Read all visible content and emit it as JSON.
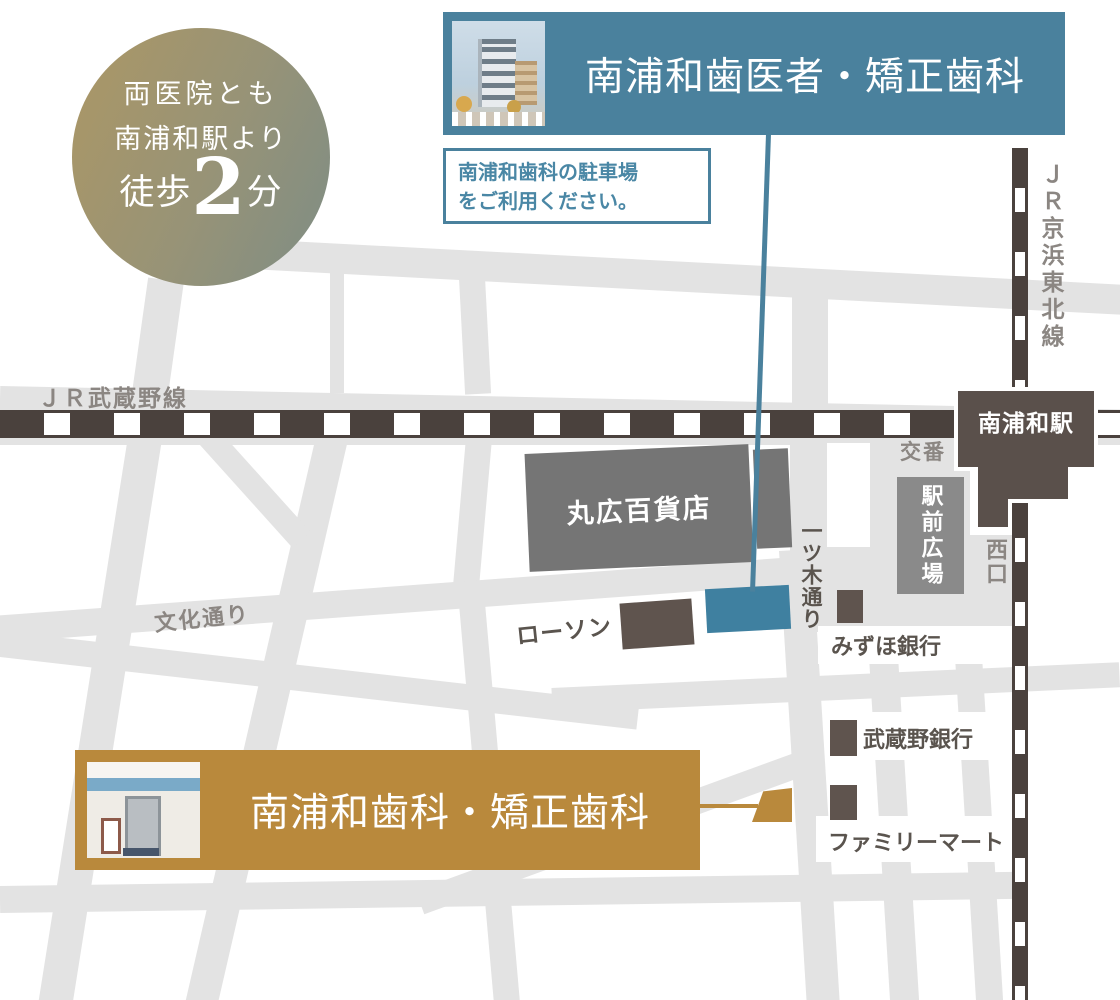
{
  "badge": {
    "line1": "両医院とも",
    "line2": "南浦和駅より",
    "walk_prefix": "徒歩",
    "walk_number": "2",
    "walk_suffix": "分"
  },
  "clinic_a": {
    "name": "南浦和歯医者・矯正歯科",
    "note_line1": "南浦和歯科の駐車場",
    "note_line2": "をご利用ください。"
  },
  "clinic_b": {
    "name": "南浦和歯科・矯正歯科"
  },
  "map": {
    "railways": {
      "musashino": "ＪＲ武蔵野線",
      "keihin_tohoku": "ＪＲ京浜東北線"
    },
    "station": {
      "name": "南浦和駅",
      "west_exit": "西口",
      "plaza": "駅前広場",
      "police_box": "交番"
    },
    "streets": {
      "hitotsugi": "一ツ木通り",
      "bunka": "文化通り"
    },
    "landmarks": {
      "maruhiro": "丸広百貨店",
      "lawson": "ローソン",
      "mizuho": "みずほ銀行",
      "musashino_bank": "武蔵野銀行",
      "familymart": "ファミリーマート"
    }
  },
  "theme": {
    "teal": "#4a819d",
    "teal_spot": "#3f80a0",
    "gold": "#b9893c",
    "road": "#e3e3e3",
    "rail": "#4a413d",
    "station": "#5a504b",
    "bldg": "#757575",
    "bldg_dark": "#5f544e",
    "lbl_gray": "#8b8682",
    "lbl_dark": "#5a544e"
  }
}
